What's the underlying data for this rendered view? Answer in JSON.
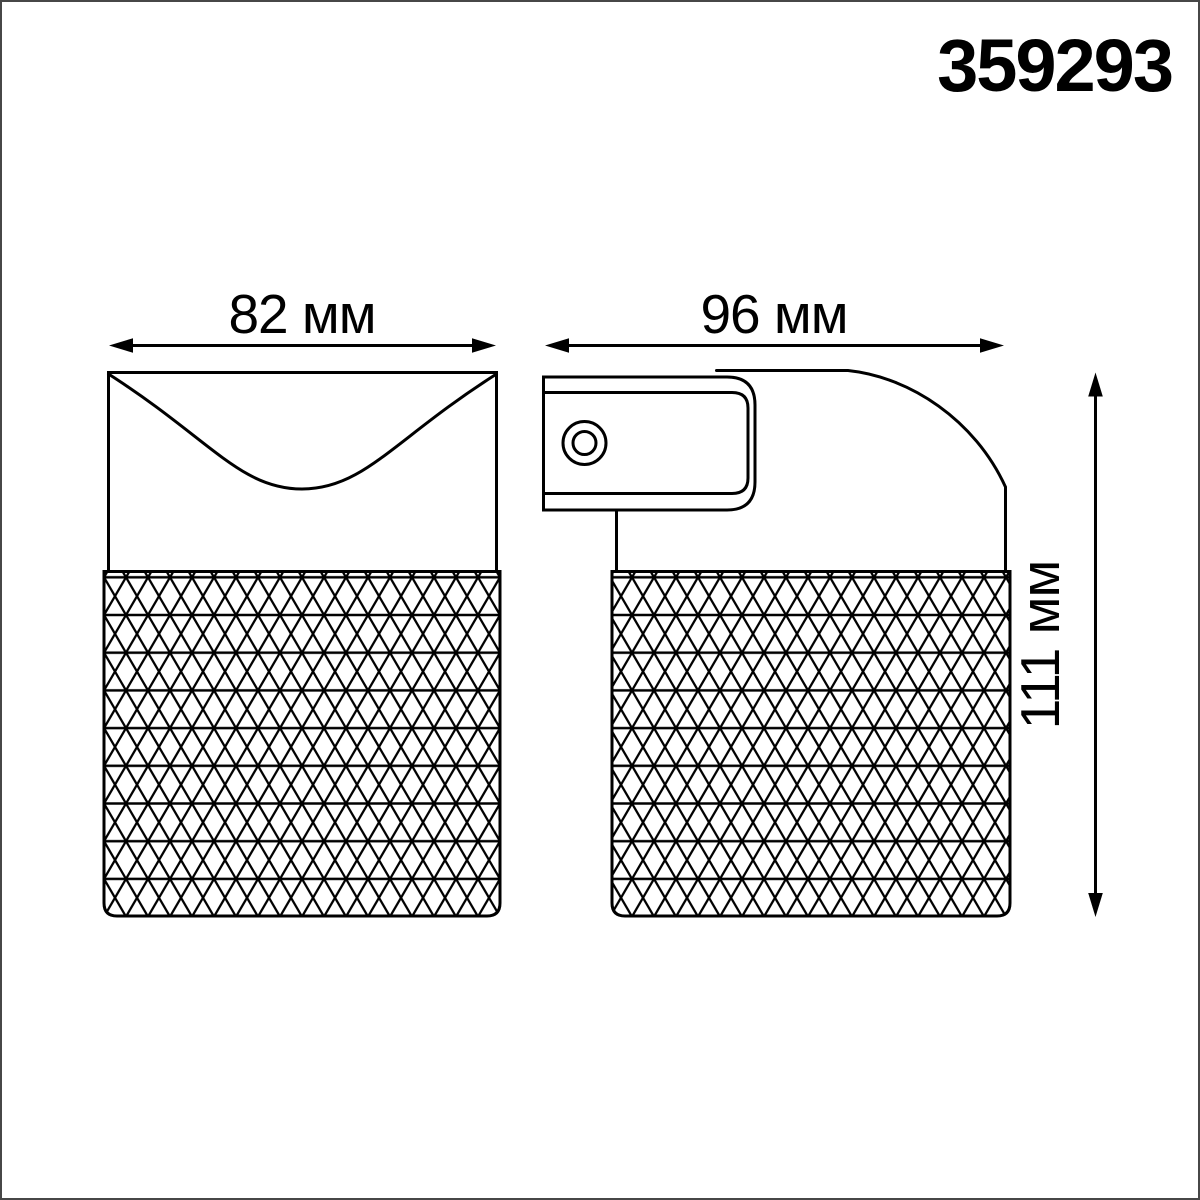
{
  "product": {
    "code": "359293"
  },
  "drawing": {
    "unit": "мм",
    "dimensions": {
      "front_width": {
        "label": "82 мм",
        "value": 82
      },
      "side_width": {
        "label": "96 мм",
        "value": 96
      },
      "height": {
        "label": "111 мм",
        "value": 111
      }
    }
  },
  "colors": {
    "ink": "#000000",
    "background": "#ffffff",
    "page_border": "#474747"
  }
}
